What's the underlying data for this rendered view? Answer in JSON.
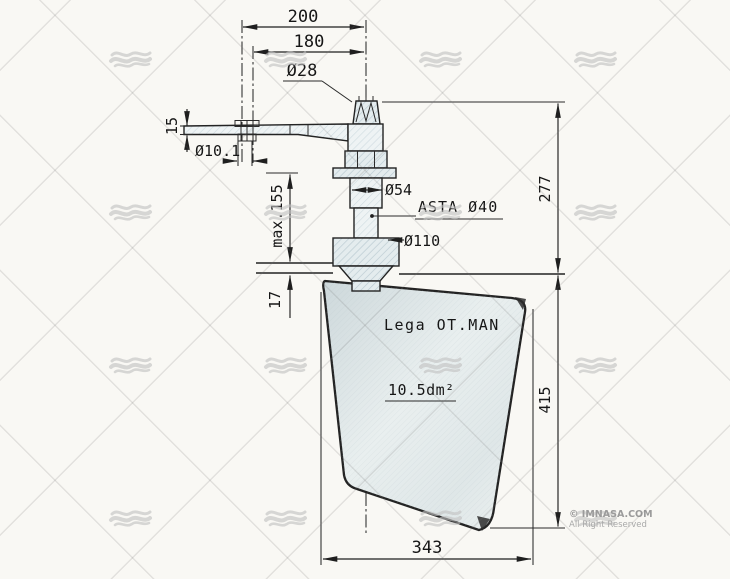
{
  "drawing": {
    "dims": {
      "d200": "200",
      "d180": "180",
      "d28": "Ø28",
      "d15": "15",
      "d101": "Ø10.1",
      "dmax155": "max.155",
      "d17": "17",
      "d277": "277",
      "d54": "Ø54",
      "asta": "ASTA Ø40",
      "d110": "Ø110",
      "d415": "415",
      "d343": "343"
    },
    "blade": {
      "material": "Lega OT.MAN",
      "area": "10.5dm²"
    },
    "watermark": {
      "copyright": "© IMNASA.COM",
      "rights": "All Right Reserved"
    },
    "colors": {
      "line": "#232323",
      "paper": "#f9f8f4",
      "blade_fill": "#d8e1e3",
      "watermark_gray": "#c2c2c2"
    }
  }
}
